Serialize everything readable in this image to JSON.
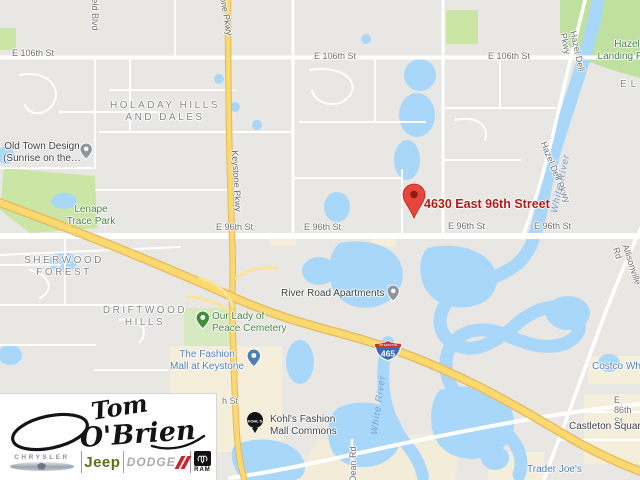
{
  "map": {
    "destination": {
      "label": "4630 East 96th Street"
    },
    "streets": {
      "e106": "E 106th St",
      "e96": "E 96th St",
      "e86": "E 86th St",
      "h_st": "h St",
      "field_blvd": "field Blvd",
      "keystone": "Keystone Pkwy",
      "hazel_dell": "Hazel Dell Pkwy",
      "allisonville": "Allisonville Rd",
      "dean": "Dean Rd"
    },
    "neighborhoods": {
      "holaday": "HOLADAY HILLS\nAND DALES",
      "sherwood": "SHERWOOD\nFOREST",
      "driftwood": "DRIFTWOOD\nHILLS",
      "el_partial": "EL"
    },
    "pois": {
      "old_town": "Old Town Design\n(Sunrise on the…",
      "lenape": "Lenape\nTrace Park",
      "hazel_landing": "Hazel\nLanding Park",
      "river_road": "River Road Apartments",
      "cemetery": "Our Lady of\nPeace Cemetery",
      "fashion_mall": "The Fashion\nMall at Keystone",
      "kohls": "Kohl's Fashion\nMall Commons",
      "castleton": "Castleton Square",
      "trader_joes": "Trader Joe's",
      "costco": "Costco Wholesale"
    },
    "water_labels": {
      "white_river": "White River"
    },
    "highway_shield": {
      "number": "465",
      "system": "INTERSTATE"
    },
    "colors": {
      "water": "#a9d7fa",
      "park_green": "#cbe5a4",
      "cemetery_green": "#d7e9c0",
      "commercial_beige": "#f5eedb",
      "highway_yellow": "#fbd96f",
      "destination_red": "#b11a15",
      "pin_red": "#e8453c",
      "poi_blue_text": "#4d7fb3",
      "poi_green_text": "#45823d"
    }
  },
  "logo": {
    "script_line1": "Tom",
    "script_line2": "O'Brien",
    "brands": {
      "chrysler": "CHRYSLER",
      "jeep": "Jeep",
      "dodge": "DODGE",
      "ram": "RAM"
    }
  }
}
